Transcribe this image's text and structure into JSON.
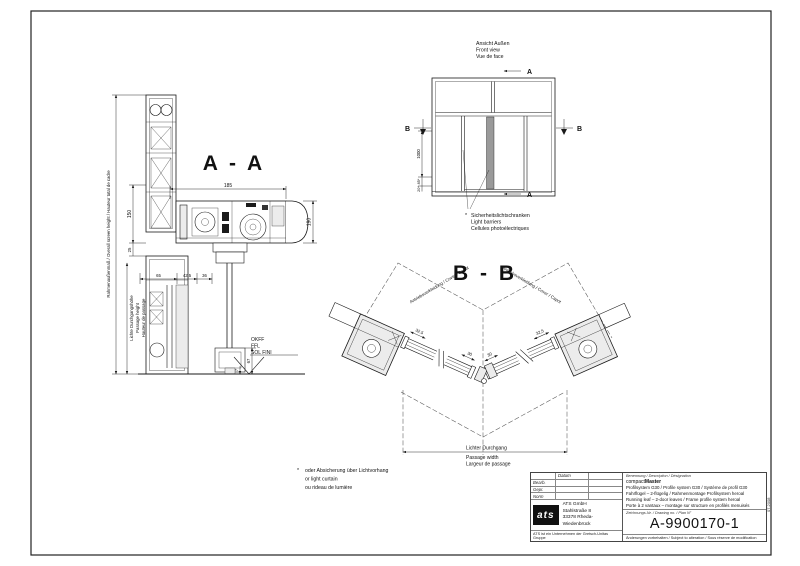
{
  "colors": {
    "line": "#1a1a1a",
    "profile_fill": "#ececec",
    "center_stile_fill": "#9a9a9a"
  },
  "sheet": {
    "edition": "07.2008"
  },
  "front_view": {
    "title_de": "Ansicht Außen",
    "title_en": "Front view",
    "title_fr": "Vue de face",
    "letter_a": "A",
    "letter_b": "B",
    "dim_height": "1000",
    "dim_small_1": "85*",
    "dim_small_2": "20*",
    "note_marker": "*",
    "note_de": "Sicherheitslichtschranken",
    "note_en": "Light barriers",
    "note_fr": "Cellules photoélectriques"
  },
  "section_aa": {
    "title": "A - A",
    "dim_185": "185",
    "dim_190": "190",
    "dim_150": "150",
    "dim_25": "25",
    "dim_65": "65",
    "dim_425": "42,5",
    "dim_36": "36",
    "dim_67": "67",
    "dim_7": "7",
    "overall_label": "Rahmenaußenmaß / Overall screen height / Hauteur total de cadre",
    "passage_de": "Lichte Durchgangshöhe",
    "passage_en": "Passage height",
    "passage_fr": "Hauteur de passage",
    "floor_1": "OKFF",
    "floor_2": "FFL",
    "floor_3": "SOL FINI"
  },
  "section_bb": {
    "title": "B - B",
    "cover_label": "Antriebsverkleidung / Cover / Capot",
    "dim_leaf": "32,5",
    "dim_center": "30",
    "passage_de": "Lichter Durchgang",
    "passage_en": "Passage width",
    "passage_fr": "Largeur de passage"
  },
  "note_light_curtain": {
    "marker": "*",
    "de": "oder Absicherung über Lichtvorhang",
    "en": "or light curtain",
    "fr": "ou rideau de lumière"
  },
  "title_block": {
    "col_datum": "Datum",
    "row_bearb": "Bearb.",
    "row_gepr": "Gepr.",
    "row_norm": "Norm",
    "logo_text": "ats",
    "company_name": "ATS GmbH",
    "street": "Stahlstraße 8",
    "city": "33378 Rheda-Wiedenbrück",
    "tagline": "ATS ist ein Unternehmen der Gretsch-Unitas Gruppe",
    "designation_header": "Benennung / Description / Désignation",
    "product_prefix": "compact",
    "product_suffix": "Master",
    "desc_line1": "Profilsystem G30 / Profile system G30 / Système de profil G30",
    "desc_line2": "Fahrflügel – 2-flügelig / Rahmenmontage Profilsystem heroal",
    "desc_line3": "Running leaf – 2-door leaves / Frame profile system heroal",
    "desc_line4": "Porte à 2 vantaux – montage sur structure en profilés menuisés",
    "drawing_no_header": "Zeichnungs-Nr. / Drawing no. / Plan N°",
    "drawing_no": "A-9900170-1",
    "footer": "Änderungen vorbehalten / Subject to alteration / Sous réserve de modification"
  }
}
